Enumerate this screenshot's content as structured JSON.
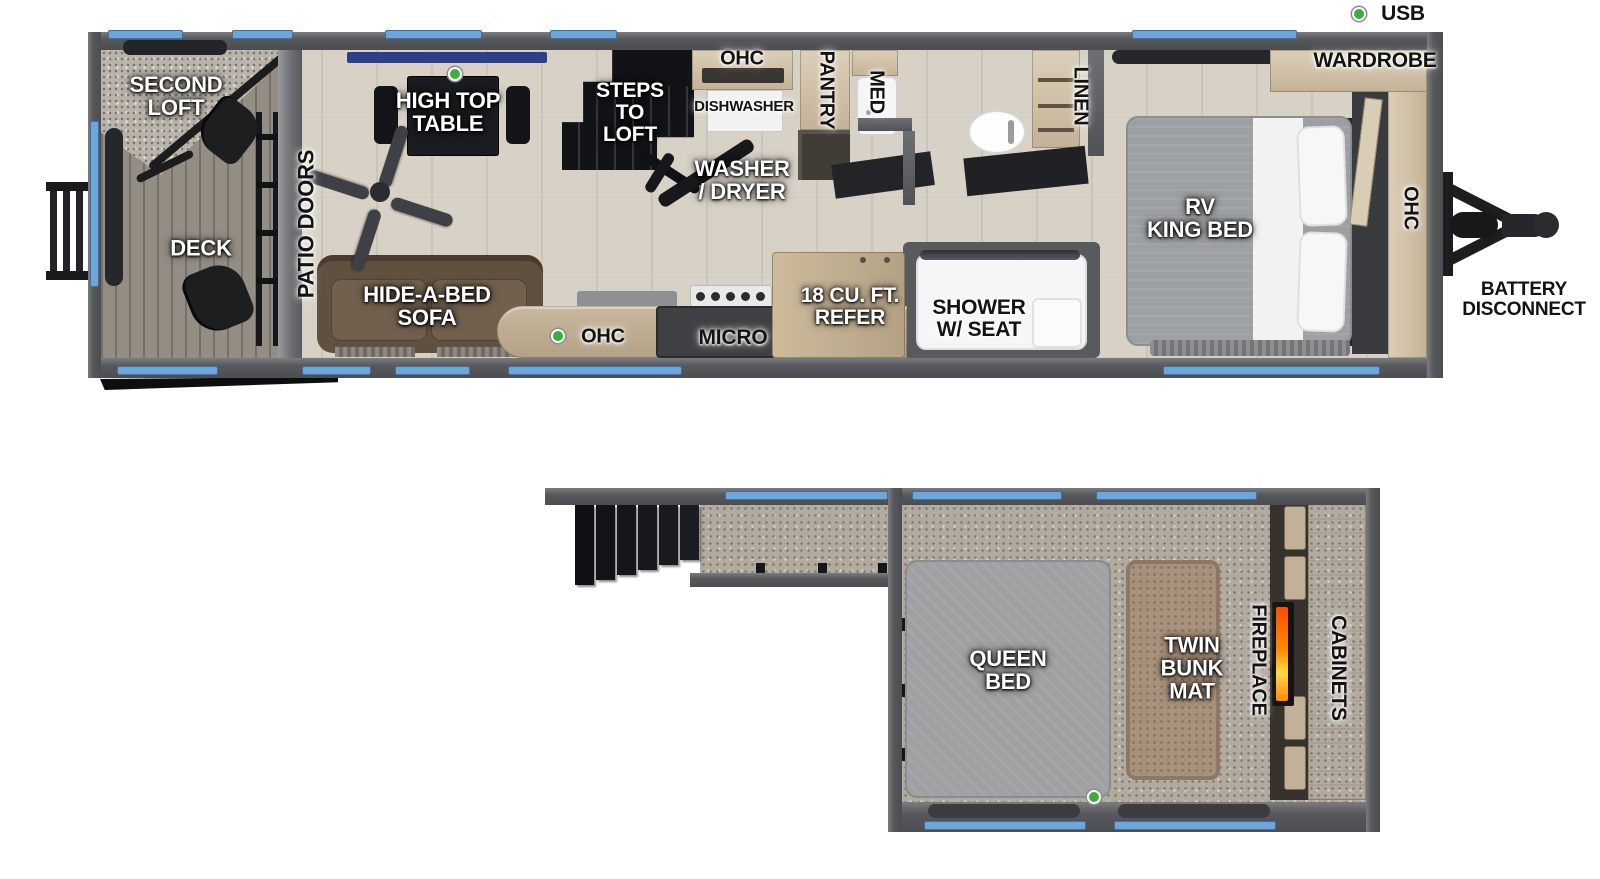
{
  "legend": {
    "usb_label": "USB"
  },
  "main_floor": {
    "second_loft": "SECOND\nLOFT",
    "deck": "DECK",
    "patio_doors": "PATIO DOORS",
    "high_top_table": "HIGH TOP\nTABLE",
    "hide_a_bed_sofa": "HIDE-A-BED\nSOFA",
    "steps_to_loft": "STEPS\nTO\nLOFT",
    "ohc_upper": "OHC",
    "dishwasher": "DISHWASHER",
    "washer_dryer": "WASHER\n/ DRYER",
    "pantry": "PANTRY",
    "med": "MED",
    "linen": "LINEN",
    "wardrobe": "WARDROBE",
    "rv_king_bed": "RV\nKING BED",
    "ohc_bedroom": "OHC",
    "ohc_kitchen": "OHC",
    "micro": "MICRO",
    "refer": "18 CU. FT.\nREFER",
    "shower": "SHOWER\nW/ SEAT",
    "battery_disconnect": "BATTERY\nDISCONNECT"
  },
  "loft_floor": {
    "queen_bed": "QUEEN\nBED",
    "twin_bunk_mat": "TWIN\nBUNK\nMAT",
    "fireplace": "FIREPLACE",
    "cabinets": "CABINETS"
  },
  "colors": {
    "window_accent": "#6fa6da",
    "usb_dot_green": "#3cae3f",
    "wall_gray": "#56575b",
    "flame_orange": "#ff8a00",
    "navy_valance": "#2c3f8d"
  }
}
